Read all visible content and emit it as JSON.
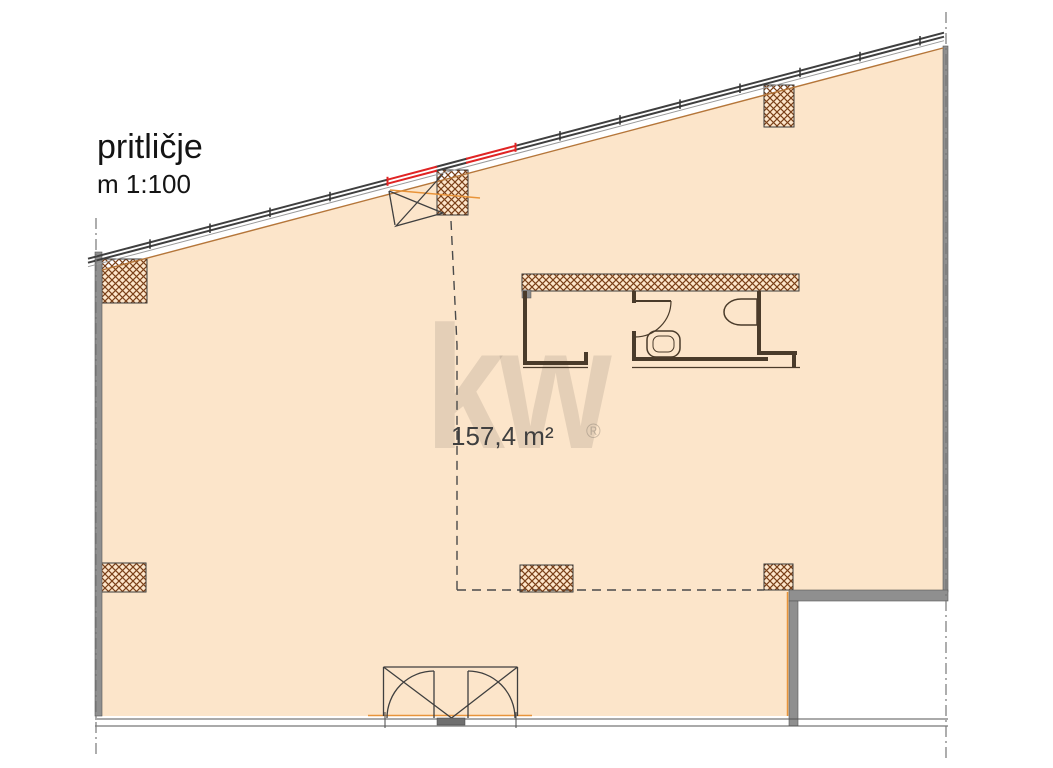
{
  "header": {
    "floor_label": "pritličje",
    "scale_label": "m 1:100"
  },
  "floor_plan": {
    "area_label": "157,4 m²",
    "colors": {
      "floor_fill": "#fce5ca",
      "wall_gray": "#8f8f8f",
      "hatch_brown": "#7a4018",
      "edge_orange": "#e8943a",
      "door_red": "#e02424"
    }
  },
  "watermark": {
    "logo_text": "kw",
    "registered_mark": "®",
    "color": "rgba(122,112,102,0.18)",
    "reg_color": "rgba(122,112,102,0.38)"
  }
}
